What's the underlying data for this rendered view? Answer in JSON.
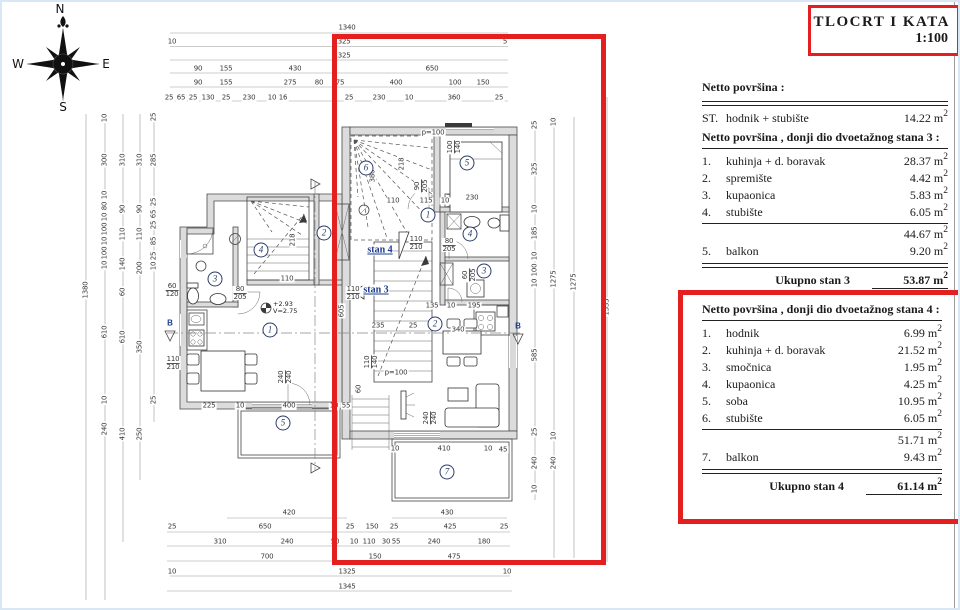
{
  "title_block": {
    "line1": "TLOCRT I KATA",
    "line2": "1:100"
  },
  "compass": {
    "n": "N",
    "e": "E",
    "s": "S",
    "w": "W"
  },
  "unit": {
    "m": "m",
    "exp": "2"
  },
  "summary": {
    "header": "Netto površina :",
    "row": {
      "num": "ST.",
      "label": "hodnik + stubište",
      "value": "14.22"
    }
  },
  "stan3": {
    "header": "Netto površina , donji dio dvoetažnog stana 3 :",
    "rows": [
      {
        "num": "1.",
        "label": "kuhinja + d. boravak",
        "value": "28.37"
      },
      {
        "num": "2.",
        "label": "spremište",
        "value": "4.42"
      },
      {
        "num": "3.",
        "label": "kupaonica",
        "value": "5.83"
      },
      {
        "num": "4.",
        "label": "stubište",
        "value": "6.05"
      }
    ],
    "subtotal": "44.67",
    "balkon": {
      "num": "5.",
      "label": "balkon",
      "value": "9.20"
    },
    "total_label": "Ukupno stan 3",
    "total": "53.87"
  },
  "stan4": {
    "header": "Netto površina , donji dio dvoetažnog stana  4 :",
    "rows": [
      {
        "num": "1.",
        "label": "hodnik",
        "value": "6.99"
      },
      {
        "num": "2.",
        "label": "kuhinja + d. boravak",
        "value": "21.52"
      },
      {
        "num": "3.",
        "label": "smočnica",
        "value": "1.95"
      },
      {
        "num": "4.",
        "label": "kupaonica",
        "value": "4.25"
      },
      {
        "num": "5.",
        "label": "soba",
        "value": "10.95"
      },
      {
        "num": "6.",
        "label": "stubište",
        "value": "6.05"
      }
    ],
    "subtotal": "51.71",
    "balkon": {
      "num": "7.",
      "label": "balkon",
      "value": "9.43"
    },
    "total_label": "Ukupno stan 4",
    "total": "61.14"
  },
  "plan": {
    "stan_labels": [
      {
        "t": "stan 4",
        "x": 378,
        "y": 248
      },
      {
        "t": "stan 3",
        "x": 374,
        "y": 288
      }
    ],
    "section_labels": [
      {
        "t": "B",
        "x": 168,
        "y": 321
      },
      {
        "t": "B",
        "x": 516,
        "y": 324
      }
    ],
    "level": {
      "l1": "+2.93",
      "l2": "V=2.75"
    },
    "rooms": [
      {
        "n": "5",
        "x": 465,
        "y": 161
      },
      {
        "n": "6",
        "x": 364,
        "y": 166
      },
      {
        "n": "1",
        "x": 426,
        "y": 213
      },
      {
        "n": "4",
        "x": 468,
        "y": 232
      },
      {
        "n": "3",
        "x": 482,
        "y": 269
      },
      {
        "n": "2",
        "x": 433,
        "y": 322
      },
      {
        "n": "7",
        "x": 445,
        "y": 470
      },
      {
        "n": "3",
        "x": 213,
        "y": 277
      },
      {
        "n": "4",
        "x": 259,
        "y": 248
      },
      {
        "n": "1",
        "x": 268,
        "y": 328
      },
      {
        "n": "2",
        "x": 322,
        "y": 231
      },
      {
        "n": "5",
        "x": 281,
        "y": 421
      }
    ],
    "labels": [
      {
        "t": "1340",
        "x": 345,
        "y": 26
      },
      {
        "t": "10",
        "x": 170,
        "y": 40
      },
      {
        "t": "1325",
        "x": 340,
        "y": 40
      },
      {
        "t": "5",
        "x": 503,
        "y": 40
      },
      {
        "t": "1325",
        "x": 340,
        "y": 54
      },
      {
        "t": "90",
        "x": 196,
        "y": 67
      },
      {
        "t": "155",
        "x": 224,
        "y": 67
      },
      {
        "t": "430",
        "x": 293,
        "y": 67
      },
      {
        "t": "650",
        "x": 430,
        "y": 67
      },
      {
        "t": "90",
        "x": 196,
        "y": 81
      },
      {
        "t": "155",
        "x": 224,
        "y": 81
      },
      {
        "t": "275",
        "x": 288,
        "y": 81
      },
      {
        "t": "80",
        "x": 317,
        "y": 81
      },
      {
        "t": "75",
        "x": 338,
        "y": 81
      },
      {
        "t": "400",
        "x": 394,
        "y": 81
      },
      {
        "t": "100",
        "x": 453,
        "y": 81
      },
      {
        "t": "150",
        "x": 481,
        "y": 81
      },
      {
        "t": "25",
        "x": 167,
        "y": 96
      },
      {
        "t": "65",
        "x": 179,
        "y": 96
      },
      {
        "t": "25",
        "x": 191,
        "y": 96
      },
      {
        "t": "130",
        "x": 206,
        "y": 96
      },
      {
        "t": "25",
        "x": 224,
        "y": 96
      },
      {
        "t": "230",
        "x": 247,
        "y": 96
      },
      {
        "t": "10",
        "x": 270,
        "y": 96
      },
      {
        "t": "16",
        "x": 281,
        "y": 96
      },
      {
        "t": "25",
        "x": 347,
        "y": 96
      },
      {
        "t": "230",
        "x": 377,
        "y": 96
      },
      {
        "t": "10",
        "x": 407,
        "y": 96
      },
      {
        "t": "360",
        "x": 452,
        "y": 96
      },
      {
        "t": "25",
        "x": 497,
        "y": 96
      },
      {
        "t": "420",
        "x": 287,
        "y": 511
      },
      {
        "t": "430",
        "x": 445,
        "y": 511
      },
      {
        "t": "25",
        "x": 170,
        "y": 525
      },
      {
        "t": "650",
        "x": 263,
        "y": 525
      },
      {
        "t": "25",
        "x": 348,
        "y": 525
      },
      {
        "t": "150",
        "x": 370,
        "y": 525
      },
      {
        "t": "25",
        "x": 392,
        "y": 525
      },
      {
        "t": "425",
        "x": 448,
        "y": 525
      },
      {
        "t": "25",
        "x": 502,
        "y": 525
      },
      {
        "t": "310",
        "x": 218,
        "y": 540
      },
      {
        "t": "240",
        "x": 285,
        "y": 540
      },
      {
        "t": "50",
        "x": 333,
        "y": 540
      },
      {
        "t": "10",
        "x": 352,
        "y": 540
      },
      {
        "t": "110",
        "x": 367,
        "y": 540
      },
      {
        "t": "30",
        "x": 384,
        "y": 540
      },
      {
        "t": "55",
        "x": 394,
        "y": 540
      },
      {
        "t": "240",
        "x": 432,
        "y": 540
      },
      {
        "t": "180",
        "x": 482,
        "y": 540
      },
      {
        "t": "700",
        "x": 265,
        "y": 555
      },
      {
        "t": "150",
        "x": 373,
        "y": 555
      },
      {
        "t": "475",
        "x": 452,
        "y": 555
      },
      {
        "t": "10",
        "x": 170,
        "y": 570
      },
      {
        "t": "1325",
        "x": 345,
        "y": 570
      },
      {
        "t": "10",
        "x": 505,
        "y": 570
      },
      {
        "t": "1345",
        "x": 345,
        "y": 585
      },
      {
        "t": "1380",
        "x": 84,
        "y": 288,
        "r": 1
      },
      {
        "t": "10",
        "x": 103,
        "y": 116,
        "r": 1
      },
      {
        "t": "300",
        "x": 103,
        "y": 158,
        "r": 1
      },
      {
        "t": "10",
        "x": 103,
        "y": 193,
        "r": 1
      },
      {
        "t": "80",
        "x": 103,
        "y": 204,
        "r": 1
      },
      {
        "t": "10",
        "x": 103,
        "y": 215,
        "r": 1
      },
      {
        "t": "100",
        "x": 103,
        "y": 227,
        "r": 1
      },
      {
        "t": "10",
        "x": 103,
        "y": 239,
        "r": 1
      },
      {
        "t": "100",
        "x": 103,
        "y": 251,
        "r": 1
      },
      {
        "t": "10",
        "x": 103,
        "y": 263,
        "r": 1
      },
      {
        "t": "610",
        "x": 103,
        "y": 330,
        "r": 1
      },
      {
        "t": "10",
        "x": 103,
        "y": 398,
        "r": 1
      },
      {
        "t": "240",
        "x": 103,
        "y": 427,
        "r": 1
      },
      {
        "t": "310",
        "x": 121,
        "y": 158,
        "r": 1
      },
      {
        "t": "90",
        "x": 121,
        "y": 207,
        "r": 1
      },
      {
        "t": "110",
        "x": 121,
        "y": 232,
        "r": 1
      },
      {
        "t": "140",
        "x": 121,
        "y": 262,
        "r": 1
      },
      {
        "t": "60",
        "x": 121,
        "y": 290,
        "r": 1
      },
      {
        "t": "610",
        "x": 121,
        "y": 335,
        "r": 1
      },
      {
        "t": "410",
        "x": 121,
        "y": 432,
        "r": 1
      },
      {
        "t": "310",
        "x": 138,
        "y": 158,
        "r": 1
      },
      {
        "t": "90",
        "x": 138,
        "y": 207,
        "r": 1
      },
      {
        "t": "110",
        "x": 138,
        "y": 232,
        "r": 1
      },
      {
        "t": "200",
        "x": 138,
        "y": 266,
        "r": 1
      },
      {
        "t": "350",
        "x": 138,
        "y": 345,
        "r": 1
      },
      {
        "t": "250",
        "x": 138,
        "y": 432,
        "r": 1
      },
      {
        "t": "25",
        "x": 152,
        "y": 115,
        "r": 1
      },
      {
        "t": "285",
        "x": 152,
        "y": 158,
        "r": 1
      },
      {
        "t": "25",
        "x": 152,
        "y": 200,
        "r": 1
      },
      {
        "t": "65",
        "x": 152,
        "y": 212,
        "r": 1
      },
      {
        "t": "25",
        "x": 152,
        "y": 223,
        "r": 1
      },
      {
        "t": "85",
        "x": 152,
        "y": 239,
        "r": 1
      },
      {
        "t": "25",
        "x": 152,
        "y": 254,
        "r": 1
      },
      {
        "t": "10",
        "x": 152,
        "y": 264,
        "r": 1
      },
      {
        "t": "25",
        "x": 152,
        "y": 398,
        "r": 1
      },
      {
        "t": "25",
        "x": 533,
        "y": 123,
        "r": 1
      },
      {
        "t": "325",
        "x": 533,
        "y": 167,
        "r": 1
      },
      {
        "t": "10",
        "x": 533,
        "y": 207,
        "r": 1
      },
      {
        "t": "185",
        "x": 533,
        "y": 231,
        "r": 1
      },
      {
        "t": "10",
        "x": 533,
        "y": 254,
        "r": 1
      },
      {
        "t": "100",
        "x": 533,
        "y": 268,
        "r": 1
      },
      {
        "t": "10",
        "x": 533,
        "y": 281,
        "r": 1
      },
      {
        "t": "585",
        "x": 533,
        "y": 353,
        "r": 1
      },
      {
        "t": "25",
        "x": 533,
        "y": 430,
        "r": 1
      },
      {
        "t": "240",
        "x": 533,
        "y": 461,
        "r": 1
      },
      {
        "t": "10",
        "x": 533,
        "y": 487,
        "r": 1
      },
      {
        "t": "10",
        "x": 552,
        "y": 120,
        "r": 1
      },
      {
        "t": "1275",
        "x": 552,
        "y": 277,
        "r": 1
      },
      {
        "t": "10",
        "x": 552,
        "y": 434,
        "r": 1
      },
      {
        "t": "240",
        "x": 552,
        "y": 461,
        "r": 1
      },
      {
        "t": "1275",
        "x": 572,
        "y": 280,
        "r": 1
      },
      {
        "t": "1535",
        "x": 605,
        "y": 305,
        "r": 1
      },
      {
        "t": "p=100",
        "x": 431,
        "y": 131
      },
      {
        "t": "100/140",
        "x": 452,
        "y": 145,
        "r": 1,
        "f": 1
      },
      {
        "t": "90/205",
        "x": 419,
        "y": 184,
        "r": 1,
        "f": 1
      },
      {
        "t": "110",
        "x": 391,
        "y": 199
      },
      {
        "t": "115",
        "x": 424,
        "y": 199
      },
      {
        "t": "10",
        "x": 443,
        "y": 199
      },
      {
        "t": "230",
        "x": 470,
        "y": 196
      },
      {
        "t": "218",
        "x": 400,
        "y": 162,
        "r": 1
      },
      {
        "t": "380",
        "x": 371,
        "y": 174,
        "r": 1
      },
      {
        "t": "110/210",
        "x": 414,
        "y": 241,
        "f": 1
      },
      {
        "t": "80/205",
        "x": 447,
        "y": 243,
        "f": 1
      },
      {
        "t": "60/205",
        "x": 467,
        "y": 273,
        "r": 1,
        "f": 1
      },
      {
        "t": "135",
        "x": 430,
        "y": 304
      },
      {
        "t": "10",
        "x": 449,
        "y": 304
      },
      {
        "t": "195",
        "x": 472,
        "y": 304
      },
      {
        "t": "340",
        "x": 456,
        "y": 328
      },
      {
        "t": "235",
        "x": 376,
        "y": 324
      },
      {
        "t": "25",
        "x": 411,
        "y": 324
      },
      {
        "t": "110/140",
        "x": 369,
        "y": 360,
        "r": 1,
        "f": 1
      },
      {
        "t": "p=100",
        "x": 394,
        "y": 371
      },
      {
        "t": "605",
        "x": 340,
        "y": 309,
        "r": 1
      },
      {
        "t": "60",
        "x": 357,
        "y": 387,
        "r": 1
      },
      {
        "t": "240/240",
        "x": 428,
        "y": 416,
        "r": 1,
        "f": 1
      },
      {
        "t": "240/240",
        "x": 283,
        "y": 375,
        "r": 1,
        "f": 1
      },
      {
        "t": "10",
        "x": 393,
        "y": 447
      },
      {
        "t": "410",
        "x": 442,
        "y": 447
      },
      {
        "t": "10",
        "x": 486,
        "y": 447
      },
      {
        "t": "45",
        "x": 501,
        "y": 448
      },
      {
        "t": "225",
        "x": 207,
        "y": 404
      },
      {
        "t": "10",
        "x": 238,
        "y": 404
      },
      {
        "t": "400",
        "x": 287,
        "y": 404
      },
      {
        "t": "10",
        "x": 332,
        "y": 404
      },
      {
        "t": "55",
        "x": 344,
        "y": 404
      },
      {
        "t": "110/210",
        "x": 351,
        "y": 291,
        "f": 1
      },
      {
        "t": "110/210",
        "x": 171,
        "y": 361,
        "f": 1
      },
      {
        "t": "60/120",
        "x": 170,
        "y": 288,
        "f": 1
      },
      {
        "t": "110",
        "x": 285,
        "y": 277
      },
      {
        "t": "218",
        "x": 291,
        "y": 238,
        "r": 1
      },
      {
        "t": "80/205",
        "x": 238,
        "y": 291,
        "f": 1
      }
    ]
  }
}
